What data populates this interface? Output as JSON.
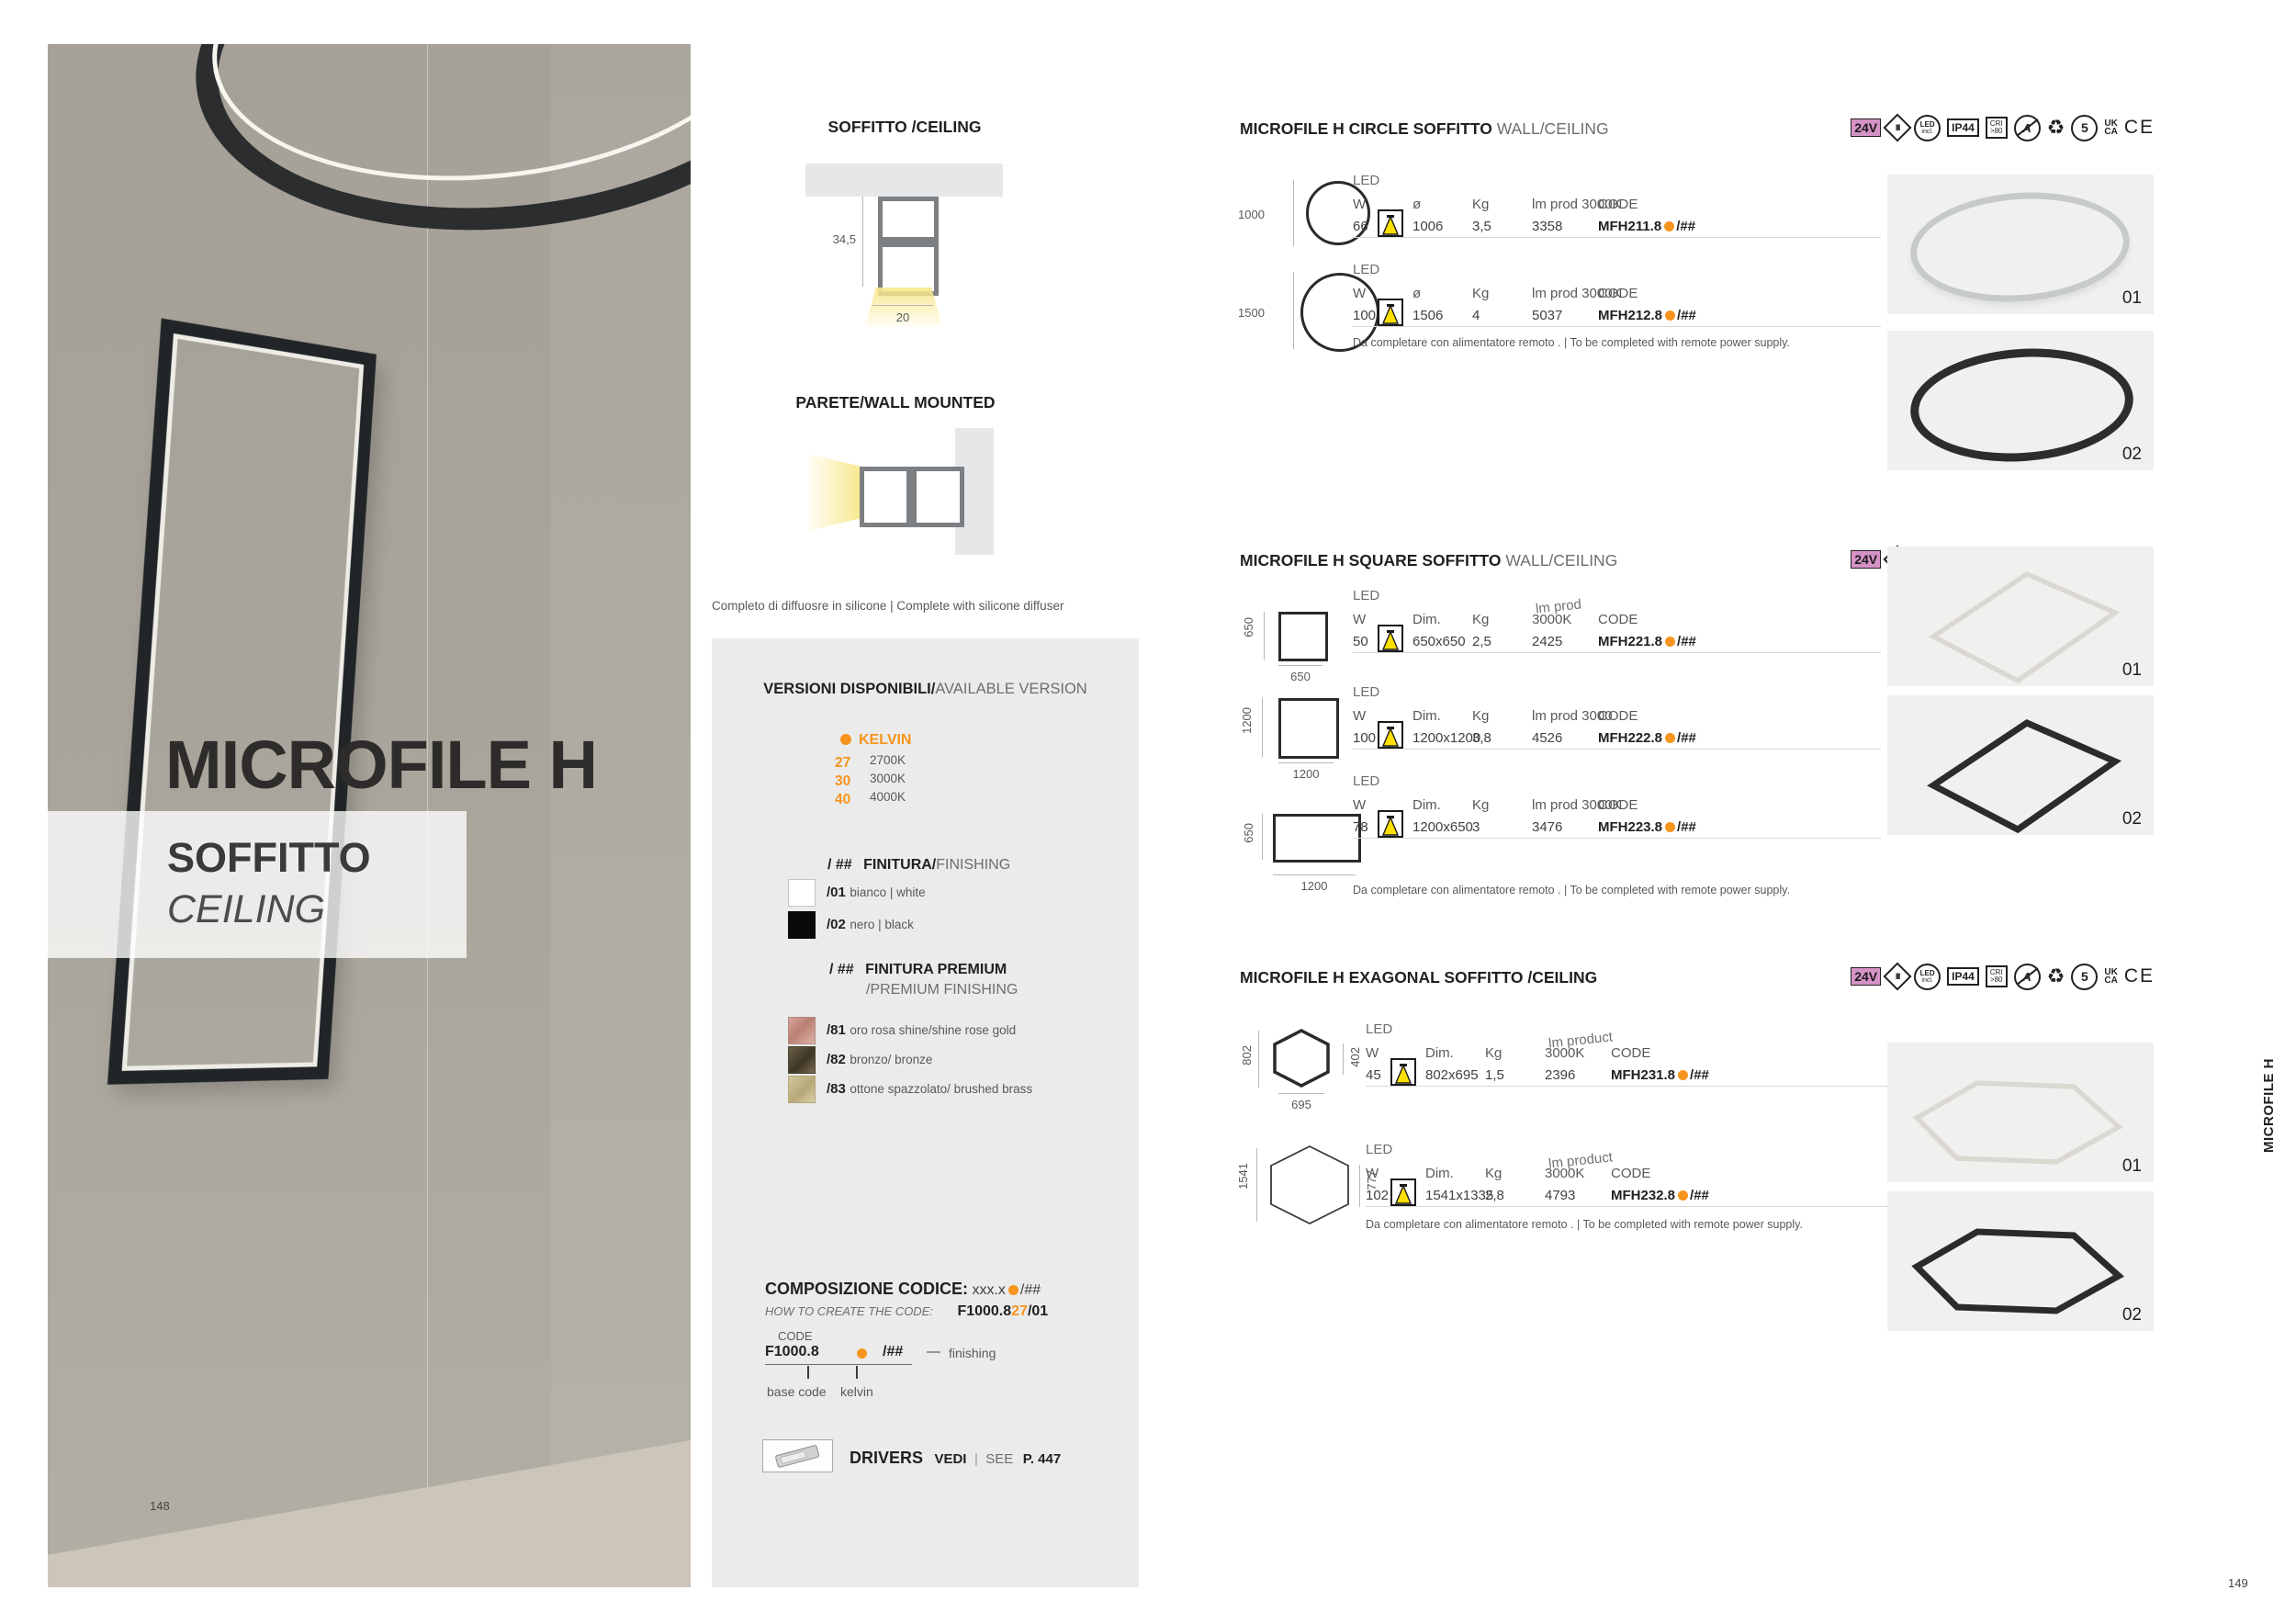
{
  "colors": {
    "accent_orange": "#F7941E",
    "badge_pink": "#D592C7"
  },
  "page": {
    "left_number": "148",
    "right_number": "149",
    "side_tab": "MICROFILE H"
  },
  "hero": {
    "title": "MICROFILE H",
    "subtitle_it": "SOFFITTO",
    "subtitle_en": "CEILING"
  },
  "diagrams": {
    "ceiling_title": "SOFFITTO /CEILING",
    "ceiling_height": "34,5",
    "ceiling_width": "20",
    "wall_title": "PARETE/WALL MOUNTED",
    "caption": "Completo di diffuosre in silicone | Complete with silicone diffuser"
  },
  "versions": {
    "title_bold": "VERSIONI DISPONIBILI/",
    "title_rest": "AVAILABLE VERSION",
    "kelvin_title": "KELVIN",
    "kelvin": [
      {
        "code": "27",
        "value": "2700K"
      },
      {
        "code": "30",
        "value": "3000K"
      },
      {
        "code": "40",
        "value": "4000K"
      }
    ],
    "fin_prefix": "/ ##",
    "fin_bold": "FINITURA/",
    "fin_rest": "FINISHING",
    "finishes": [
      {
        "code": "/01",
        "label": "bianco | white"
      },
      {
        "code": "/02",
        "label": "nero | black"
      }
    ],
    "prem_prefix": "/ ##",
    "prem_bold": "FINITURA PREMIUM",
    "prem_rest": "/PREMIUM FINISHING",
    "premium": [
      {
        "code": "/81",
        "label": "oro rosa shine/shine rose gold"
      },
      {
        "code": "/82",
        "label": "bronzo/ bronze"
      },
      {
        "code": "/83",
        "label": "ottone spazzolato/ brushed brass"
      }
    ]
  },
  "codecomp": {
    "title": "COMPOSIZIONE CODICE:",
    "example": "xxx.x",
    "example_suffix": "/##",
    "howto": "HOW TO CREATE THE CODE:",
    "sample_pre": "F1000.8",
    "sample_kelvin": "27",
    "sample_fin": "/01",
    "code_label": "CODE",
    "base": "F1000.8",
    "suffix": "/##",
    "dash": "—",
    "finishing": "finishing",
    "base_label": "base code",
    "kelvin_label": "kelvin"
  },
  "drivers": {
    "label": "DRIVERS",
    "vedi": "VEDI",
    "sep": "|",
    "see": "SEE",
    "page": "P. 447"
  },
  "badges": {
    "v24": "24V",
    "class3": "III",
    "led1": "LED",
    "led2": "incl.",
    "ip": "IP44",
    "cri1": "CRI",
    "cri2": ">80",
    "a": "A",
    "recycle": "♻",
    "five": "5",
    "uk": "UK",
    "ca": "CA",
    "ce": "CE"
  },
  "sections": [
    {
      "title": "MICROFILE H CIRCLE SOFFITTO",
      "subtitle": "WALL/CEILING",
      "note": "Da completare con alimentatore remoto .  | To be completed with remote power supply.",
      "variants": [
        "01",
        "02"
      ],
      "rows": [
        {
          "size": "1000",
          "led": "LED",
          "hw": "W",
          "hdim": "ø",
          "hkg": "Kg",
          "hlm_top": "",
          "hlm": "lm prod 3000K",
          "hcode": "CODE",
          "w": "66",
          "dim": "1006",
          "kg": "3,5",
          "lm": "3358",
          "code": "MFH211.8",
          "suffix": "/##"
        },
        {
          "size": "1500",
          "led": "LED",
          "hw": "W",
          "hdim": "ø",
          "hkg": "Kg",
          "hlm_top": "",
          "hlm": "lm prod 3000K",
          "hcode": "CODE",
          "w": "100",
          "dim": "1506",
          "kg": "4",
          "lm": "5037",
          "code": "MFH212.8",
          "suffix": "/##"
        }
      ]
    },
    {
      "title": "MICROFILE H SQUARE SOFFITTO",
      "subtitle": "WALL/CEILING",
      "note": "Da completare con alimentatore remoto .  | To be completed with remote power supply.",
      "variants": [
        "01",
        "02"
      ],
      "rows": [
        {
          "side": "650",
          "bottom": "650",
          "led": "LED",
          "hw": "W",
          "hdim": "Dim.",
          "hkg": "Kg",
          "hlm_top": "lm prod",
          "hlm": "3000K",
          "hcode": "CODE",
          "w": "50",
          "dim": "650x650",
          "kg": "2,5",
          "lm": "2425",
          "code": "MFH221.8",
          "suffix": "/##"
        },
        {
          "side": "1200",
          "bottom": "1200",
          "led": "LED",
          "hw": "W",
          "hdim": "Dim.",
          "hkg": "Kg",
          "hlm_top": "",
          "hlm": "lm prod 3000",
          "hcode": "CODE",
          "w": "100",
          "dim": "1200x1200",
          "kg": "3,8",
          "lm": "4526",
          "code": "MFH222.8",
          "suffix": "/##"
        },
        {
          "side": "650",
          "bottom": "1200",
          "led": "LED",
          "hw": "W",
          "hdim": "Dim.",
          "hkg": "Kg",
          "hlm_top": "",
          "hlm": "lm prod 3000K",
          "hcode": "CODE",
          "w": "78",
          "dim": "1200x650",
          "kg": "3",
          "lm": "3476",
          "code": "MFH223.8",
          "suffix": "/##"
        }
      ]
    },
    {
      "title": "MICROFILE H EXAGONAL SOFFITTO /CEILING",
      "subtitle": "",
      "note": "Da completare con alimentatore remoto .  | To be completed with remote power supply.",
      "variants": [
        "01",
        "02"
      ],
      "rows": [
        {
          "left": "802",
          "right": "402",
          "bottom": "695",
          "led": "LED",
          "hw": "W",
          "hdim": "Dim.",
          "hkg": "Kg",
          "hlm_top": "lm product",
          "hlm": "3000K",
          "hcode": "CODE",
          "w": "45",
          "dim": "802x695",
          "kg": "1,5",
          "lm": "2396",
          "code": "MFH231.8",
          "suffix": "/##"
        },
        {
          "left": "1541",
          "right": "777",
          "bottom": "",
          "led": "LED",
          "hw": "W",
          "hdim": "Dim.",
          "hkg": "Kg",
          "hlm_top": "lm product",
          "hlm": "3000K",
          "hcode": "CODE",
          "w": "102",
          "dim": "1541x1335",
          "kg": "2,8",
          "lm": "4793",
          "code": "MFH232.8",
          "suffix": "/##"
        }
      ]
    }
  ]
}
